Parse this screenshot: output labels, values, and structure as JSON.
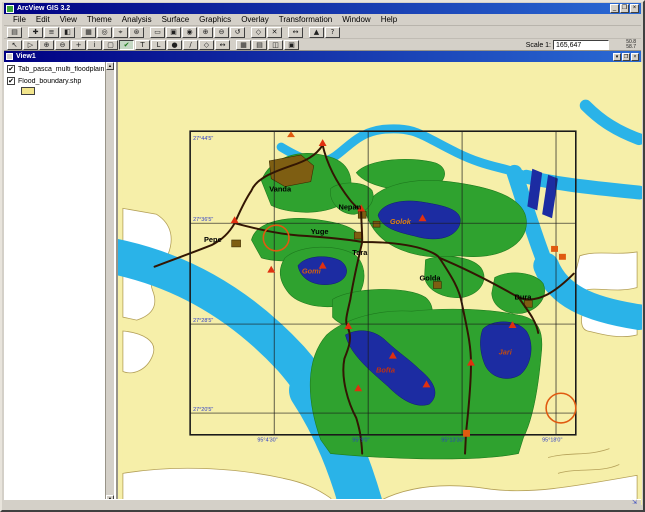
{
  "window": {
    "title": "ArcView GIS 3.2",
    "minimize": "_",
    "maximize": "❐",
    "close": "×"
  },
  "menu": {
    "items": [
      "File",
      "Edit",
      "View",
      "Theme",
      "Analysis",
      "Surface",
      "Graphics",
      "Overlay",
      "Transformation",
      "Window",
      "Help"
    ]
  },
  "toolbar1": {
    "buttons": [
      {
        "name": "save-project",
        "glyph": "▤"
      },
      {
        "gap": true
      },
      {
        "name": "add-theme",
        "glyph": "✚"
      },
      {
        "name": "theme-properties",
        "glyph": "≡"
      },
      {
        "name": "edit-legend",
        "glyph": "◧"
      },
      {
        "gap": true
      },
      {
        "name": "open-table",
        "glyph": "▦"
      },
      {
        "name": "find",
        "glyph": "◎"
      },
      {
        "name": "locate",
        "glyph": "⌖"
      },
      {
        "name": "query-builder",
        "glyph": "⊛"
      },
      {
        "gap": true
      },
      {
        "name": "zoom-full-extent",
        "glyph": "▭"
      },
      {
        "name": "zoom-active-theme",
        "glyph": "▣"
      },
      {
        "name": "zoom-selected",
        "glyph": "◉"
      },
      {
        "name": "zoom-in",
        "glyph": "⊕"
      },
      {
        "name": "zoom-out",
        "glyph": "⊖"
      },
      {
        "name": "zoom-previous",
        "glyph": "↺"
      },
      {
        "gap": true
      },
      {
        "name": "select-features",
        "glyph": "◇"
      },
      {
        "name": "clear-selection",
        "glyph": "✕"
      },
      {
        "gap": true
      },
      {
        "name": "hot-link",
        "glyph": "↔"
      },
      {
        "gap": true
      },
      {
        "name": "create-chart",
        "glyph": "▲"
      },
      {
        "name": "help",
        "glyph": "?"
      }
    ]
  },
  "toolbar2": {
    "buttons": [
      {
        "name": "pointer-tool",
        "glyph": "↖"
      },
      {
        "name": "vertex-edit-tool",
        "glyph": "▷"
      },
      {
        "name": "zoom-in-tool",
        "glyph": "⊕"
      },
      {
        "name": "zoom-out-tool",
        "glyph": "⊖"
      },
      {
        "name": "pan-tool",
        "glyph": "+"
      },
      {
        "name": "identify-tool",
        "glyph": "i"
      },
      {
        "name": "select-box-tool",
        "glyph": "▢"
      },
      {
        "name": "draw-tool",
        "glyph": "✔",
        "pressed": true,
        "color": "#1a7a1a"
      },
      {
        "name": "text-tool",
        "glyph": "T"
      },
      {
        "name": "label-tool",
        "glyph": "L"
      },
      {
        "name": "point-tool",
        "glyph": "●"
      },
      {
        "name": "line-tool",
        "glyph": "∕"
      },
      {
        "name": "polygon-tool",
        "glyph": "◇"
      },
      {
        "name": "measure-tool",
        "glyph": "↔"
      },
      {
        "gap": true
      },
      {
        "name": "area-of-interest",
        "glyph": "▦"
      },
      {
        "name": "attribute-table",
        "glyph": "▤"
      },
      {
        "name": "chart-view",
        "glyph": "◫"
      },
      {
        "name": "layout-view",
        "glyph": "▣"
      }
    ],
    "scale_label": "Scale 1:",
    "scale_value": "165,647",
    "coord_x": "50.8",
    "coord_y": "58.7"
  },
  "view_window": {
    "title": "View1",
    "minimize": "▾",
    "maximize": "❐",
    "close": "×"
  },
  "legend": {
    "themes": [
      {
        "check": "✔",
        "label": "Tab_pasca_multi_floodplain.tif"
      },
      {
        "check": "✔",
        "label": "Flood_boundary.shp",
        "swatch": "#f2e58c"
      }
    ],
    "scroll_up": "▲",
    "scroll_down": "▼"
  },
  "map": {
    "labels": {
      "vanda": "Vanda",
      "nepan": "Nepan",
      "pepe": "Pepe",
      "yuge": "Yuge",
      "tara": "Tara",
      "golda": "Golda",
      "dura": "Dura",
      "golok": "Golok",
      "gomi": "Gomi",
      "bofta": "Bofta",
      "jari": "Jari"
    },
    "graticule": {
      "lat": [
        "27°44'5\"",
        "27°36'5\"",
        "27°28'5\"",
        "27°20'5\""
      ],
      "lon": [
        "95°4'30\"",
        "95°9'0\"",
        "95°13'30\"",
        "95°18'0\""
      ]
    },
    "colors": {
      "background": "#f6efa9",
      "river": "#2ab3e8",
      "forest": "#2fa22f",
      "lake": "#1c2ca2",
      "road": "#331603",
      "village": "#7e5e12",
      "marker": "#e03010",
      "circle": "#e05a10",
      "coord_text": "#2b3bc8"
    }
  },
  "statusbar": {
    "resize_grip": "⇲"
  }
}
